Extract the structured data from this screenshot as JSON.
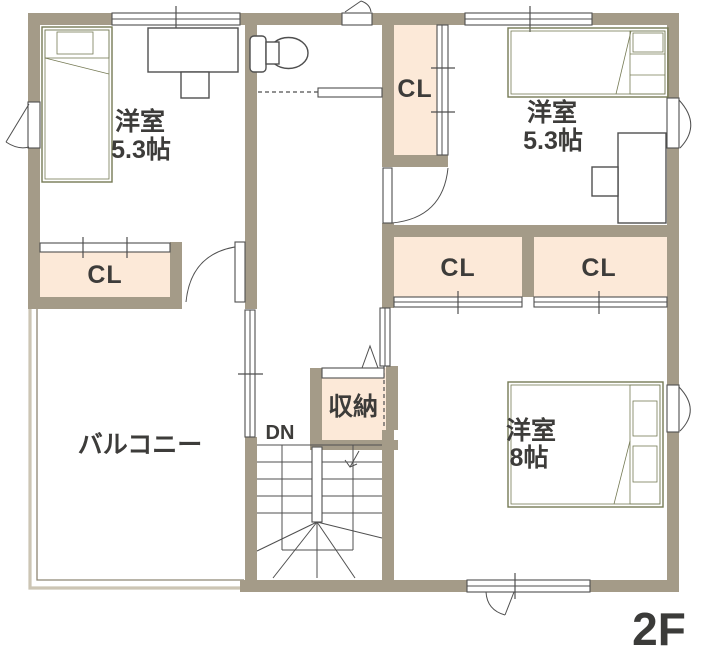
{
  "floor": {
    "label": "2F"
  },
  "rooms": {
    "bedroom_nw": {
      "type_label": "洋室",
      "size_label": "5.3帖"
    },
    "bedroom_ne": {
      "type_label": "洋室",
      "size_label": "5.3帖"
    },
    "bedroom_se": {
      "type_label": "洋室",
      "size_label": "8帖"
    },
    "balcony": {
      "label": "バルコニー"
    },
    "storage": {
      "label": "収納"
    },
    "stairs": {
      "label": "DN"
    },
    "closets": {
      "nw": {
        "label": "CL"
      },
      "hall": {
        "label": "CL"
      },
      "mid_left": {
        "label": "CL"
      },
      "mid_right": {
        "label": "CL"
      }
    }
  },
  "colors": {
    "wall": "#a49b88",
    "closet_fill": "#fce9d8",
    "bed_fill": "#e9f2cd",
    "bed_stroke": "#767b55",
    "line": "#4f4f4f",
    "text": "#3d3c3a",
    "balcony_outer": "#ccc5b4",
    "balcony_inner": "#8e8674"
  }
}
